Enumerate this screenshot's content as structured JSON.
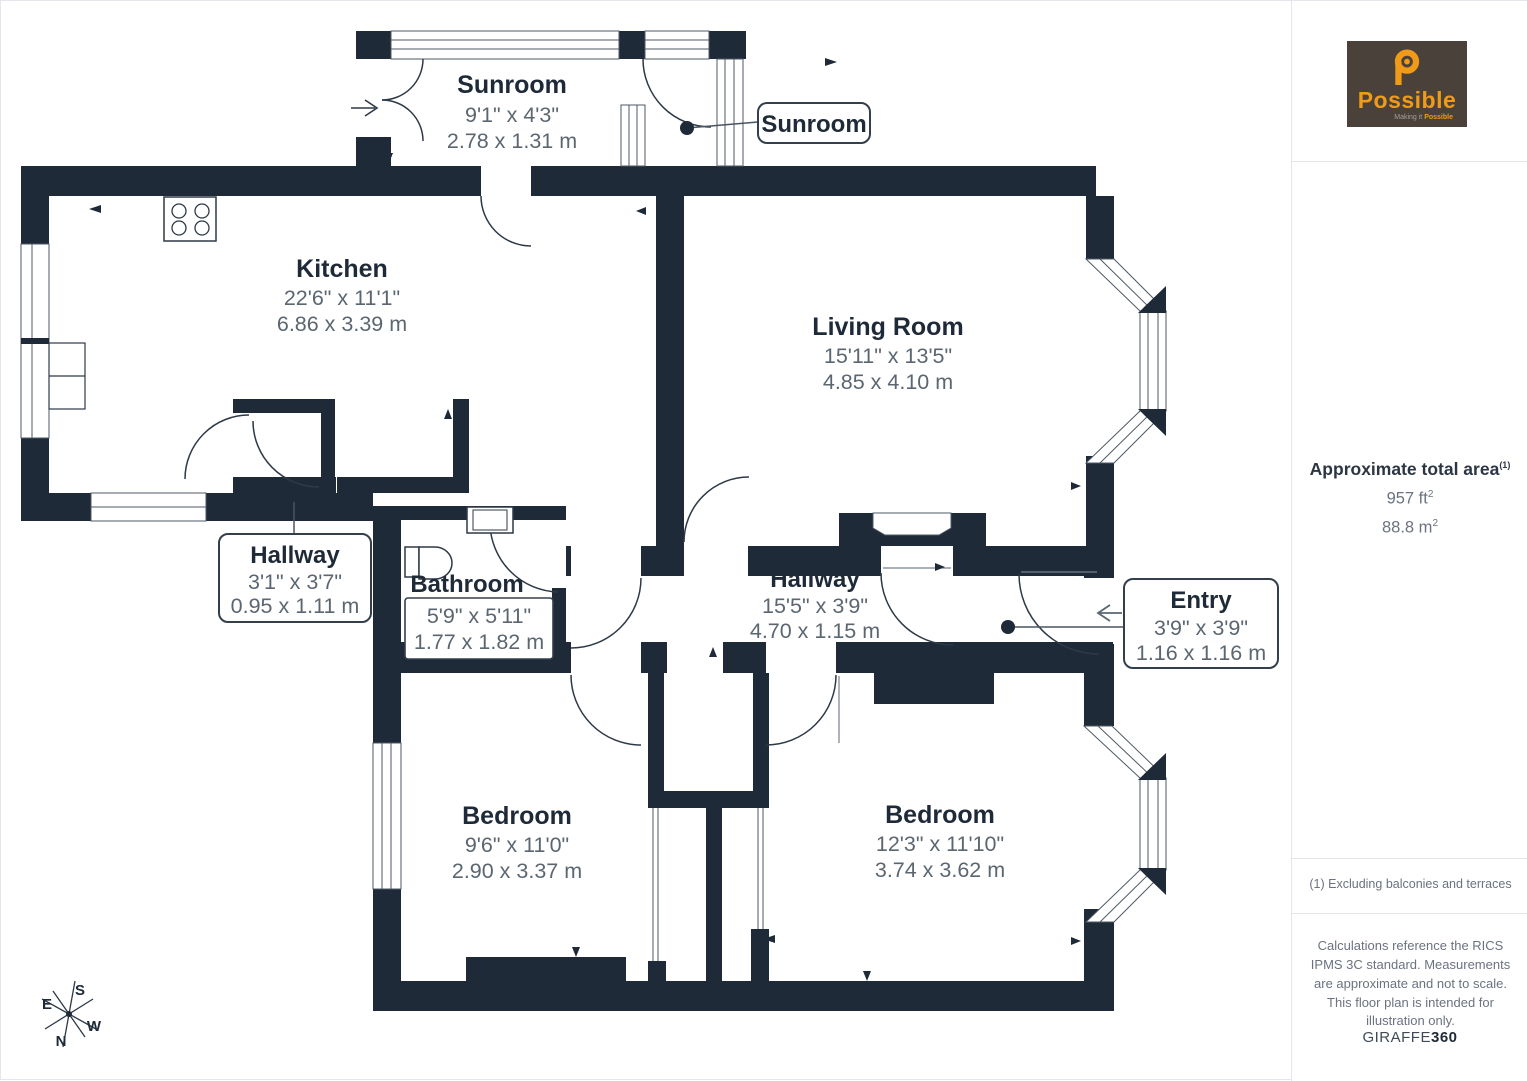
{
  "branding": {
    "logo_name": "Possible",
    "tagline_prefix": "Making it",
    "tagline_bold": "Possible",
    "giraffe_prefix": "GIRAFFE",
    "giraffe_suffix": "360"
  },
  "sidebar": {
    "area_title": "Approximate total area",
    "area_marker": "(1)",
    "area_ft": "957 ft",
    "area_m": "88.8 m",
    "sup": "2",
    "footnote": "(1) Excluding balconies and terraces",
    "disclaimer": "Calculations reference the RICS IPMS 3C standard. Measurements are approximate and not to scale. This floor plan is intended for illustration only."
  },
  "rooms": [
    {
      "name": "Sunroom",
      "imperial": "9'1\" x 4'3\"",
      "metric": "2.78 x 1.31 m"
    },
    {
      "name": "Kitchen",
      "imperial": "22'6\" x 11'1\"",
      "metric": "6.86 x 3.39 m"
    },
    {
      "name": "Living Room",
      "imperial": "15'11\" x 13'5\"",
      "metric": "4.85 x 4.10 m"
    },
    {
      "name": "Hallway",
      "imperial": "3'1\" x 3'7\"",
      "metric": "0.95 x 1.11 m"
    },
    {
      "name": "Bathroom",
      "imperial": "5'9\" x 5'11\"",
      "metric": "1.77 x 1.82 m"
    },
    {
      "name": "Hallway",
      "imperial": "15'5\" x 3'9\"",
      "metric": "4.70 x 1.15 m"
    },
    {
      "name": "Entry",
      "imperial": "3'9\" x 3'9\"",
      "metric": "1.16 x 1.16 m"
    },
    {
      "name": "Bedroom",
      "imperial": "9'6\" x 11'0\"",
      "metric": "2.90 x 3.37 m"
    },
    {
      "name": "Bedroom",
      "imperial": "12'3\" x 11'10\"",
      "metric": "3.74 x 3.62 m"
    }
  ],
  "compass": {
    "n": "N",
    "s": "S",
    "e": "E",
    "w": "W"
  },
  "colors": {
    "wall": "#1f2a38",
    "window_line": "#4e5a66",
    "room_name_text": "#1f2a38",
    "dimension_text": "#5b6671",
    "logo_background": "#4a423a",
    "logo_orange": "#f09a1a",
    "divider": "#e3e6ea"
  }
}
